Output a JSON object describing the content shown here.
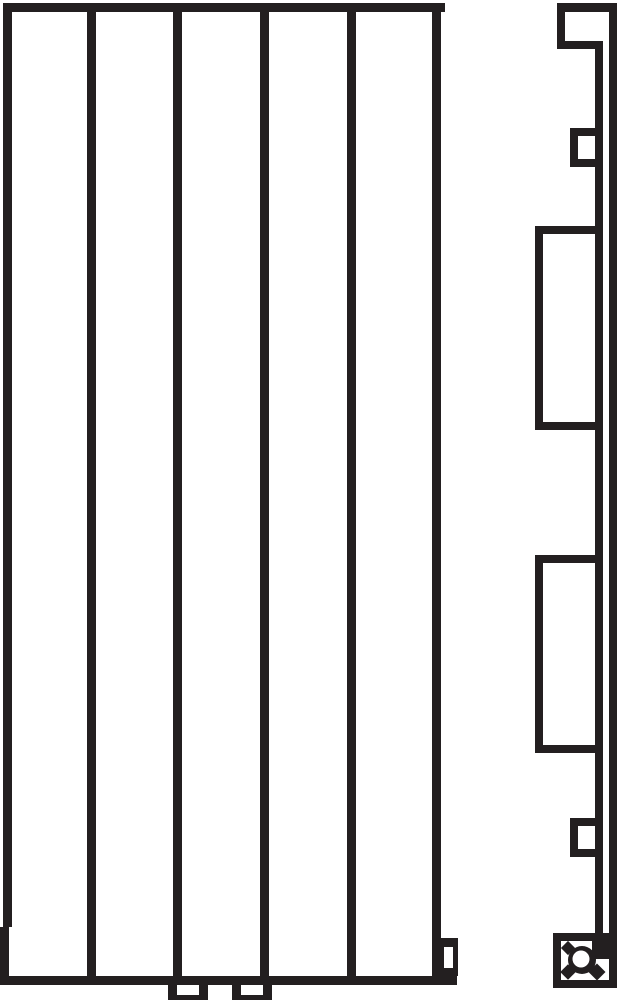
{
  "canvas": {
    "width": 621,
    "height": 1000,
    "background_color": "#ffffff",
    "line_color": "#231f20"
  },
  "drawing": {
    "views": [
      {
        "name": "front-view",
        "shapes": [
          {
            "name": "front-top-edge",
            "type": "rect",
            "x": 3,
            "y": 3,
            "w": 442,
            "h": 9,
            "fill": "ink"
          },
          {
            "name": "front-left-edge-upper",
            "type": "rect",
            "x": 3,
            "y": 3,
            "w": 9,
            "h": 924,
            "fill": "ink"
          },
          {
            "name": "front-left-edge-lower",
            "type": "rect",
            "x": 0,
            "y": 927,
            "w": 9,
            "h": 49,
            "fill": "ink"
          },
          {
            "name": "front-right-edge",
            "type": "rect",
            "x": 432,
            "y": 3,
            "w": 9,
            "h": 973,
            "fill": "ink"
          },
          {
            "name": "front-bottom-edge",
            "type": "rect",
            "x": 0,
            "y": 976,
            "w": 457,
            "h": 9,
            "fill": "ink"
          },
          {
            "name": "panel-divider-1",
            "type": "rect",
            "x": 87,
            "y": 9,
            "w": 9,
            "h": 967,
            "fill": "ink"
          },
          {
            "name": "panel-divider-2",
            "type": "rect",
            "x": 173,
            "y": 9,
            "w": 9,
            "h": 967,
            "fill": "ink"
          },
          {
            "name": "panel-divider-3",
            "type": "rect",
            "x": 260,
            "y": 9,
            "w": 9,
            "h": 967,
            "fill": "ink"
          },
          {
            "name": "panel-divider-4",
            "type": "rect",
            "x": 347,
            "y": 9,
            "w": 9,
            "h": 967,
            "fill": "ink"
          },
          {
            "name": "bottom-stub-1-outer",
            "type": "rect",
            "x": 168,
            "y": 985,
            "w": 40,
            "h": 15,
            "fill": "ink"
          },
          {
            "name": "bottom-stub-1-inner",
            "type": "rect",
            "x": 177,
            "y": 985,
            "w": 22,
            "h": 10,
            "fill": "paper"
          },
          {
            "name": "bottom-stub-2-outer",
            "type": "rect",
            "x": 232,
            "y": 985,
            "w": 40,
            "h": 15,
            "fill": "ink"
          },
          {
            "name": "bottom-stub-2-inner",
            "type": "rect",
            "x": 241,
            "y": 985,
            "w": 22,
            "h": 10,
            "fill": "paper"
          },
          {
            "name": "bottom-right-tab-outer",
            "type": "rect",
            "x": 441,
            "y": 938,
            "w": 17,
            "h": 38,
            "fill": "ink"
          },
          {
            "name": "bottom-right-tab-inner",
            "type": "rect",
            "x": 444,
            "y": 947,
            "w": 9,
            "h": 21,
            "fill": "paper"
          }
        ]
      },
      {
        "name": "side-view",
        "shapes": [
          {
            "name": "side-top-cap-top-edge",
            "type": "rect",
            "x": 557,
            "y": 3,
            "w": 60,
            "h": 9,
            "fill": "ink"
          },
          {
            "name": "side-top-cap-left-edge",
            "type": "rect",
            "x": 557,
            "y": 3,
            "w": 8,
            "h": 46,
            "fill": "ink"
          },
          {
            "name": "side-top-cap-bottom-edge",
            "type": "rect",
            "x": 557,
            "y": 41,
            "w": 46,
            "h": 8,
            "fill": "ink"
          },
          {
            "name": "side-outer-line",
            "type": "rect",
            "x": 609,
            "y": 3,
            "w": 8,
            "h": 985,
            "fill": "ink"
          },
          {
            "name": "side-inner-line",
            "type": "rect",
            "x": 595,
            "y": 41,
            "w": 8,
            "h": 900,
            "fill": "ink"
          },
          {
            "name": "bracket-tab-1-outer",
            "type": "rect",
            "x": 570,
            "y": 128,
            "w": 33,
            "h": 39,
            "fill": "ink"
          },
          {
            "name": "bracket-tab-1-inner",
            "type": "rect",
            "x": 578,
            "y": 136,
            "w": 17,
            "h": 23,
            "fill": "paper"
          },
          {
            "name": "mounting-box-1-outer",
            "type": "rect",
            "x": 535,
            "y": 226,
            "w": 68,
            "h": 204,
            "fill": "ink"
          },
          {
            "name": "mounting-box-1-inner",
            "type": "rect",
            "x": 543,
            "y": 234,
            "w": 52,
            "h": 188,
            "fill": "paper"
          },
          {
            "name": "mounting-box-2-outer",
            "type": "rect",
            "x": 535,
            "y": 555,
            "w": 68,
            "h": 198,
            "fill": "ink"
          },
          {
            "name": "mounting-box-2-inner",
            "type": "rect",
            "x": 543,
            "y": 563,
            "w": 52,
            "h": 182,
            "fill": "paper"
          },
          {
            "name": "bracket-tab-2-outer",
            "type": "rect",
            "x": 570,
            "y": 818,
            "w": 33,
            "h": 39,
            "fill": "ink"
          },
          {
            "name": "bracket-tab-2-inner",
            "type": "rect",
            "x": 578,
            "y": 826,
            "w": 17,
            "h": 23,
            "fill": "paper"
          },
          {
            "name": "bottom-cap-outer",
            "type": "rect",
            "x": 553,
            "y": 933,
            "w": 64,
            "h": 55,
            "fill": "ink"
          },
          {
            "name": "bottom-cap-inner",
            "type": "rect",
            "x": 561,
            "y": 941,
            "w": 48,
            "h": 39,
            "fill": "paper"
          },
          {
            "name": "pipe-corner-block",
            "type": "rect",
            "x": 592,
            "y": 941,
            "w": 17,
            "h": 18,
            "fill": "ink"
          },
          {
            "name": "pipe-lug-nw",
            "type": "diamond",
            "cx": 568,
            "cy": 948,
            "s": 10,
            "fill": "ink"
          },
          {
            "name": "pipe-lug-sw",
            "type": "diamond",
            "cx": 568,
            "cy": 972,
            "s": 11,
            "fill": "ink"
          },
          {
            "name": "pipe-lug-se",
            "type": "diamond",
            "cx": 597,
            "cy": 972,
            "s": 12,
            "fill": "ink"
          },
          {
            "name": "pipe-outer-circle",
            "type": "circle",
            "cx": 582,
            "cy": 960,
            "r": 14,
            "fill": "ink"
          },
          {
            "name": "pipe-bore-circle",
            "type": "circle",
            "cx": 581,
            "cy": 959,
            "r": 8.5,
            "fill": "paper"
          }
        ]
      }
    ]
  }
}
